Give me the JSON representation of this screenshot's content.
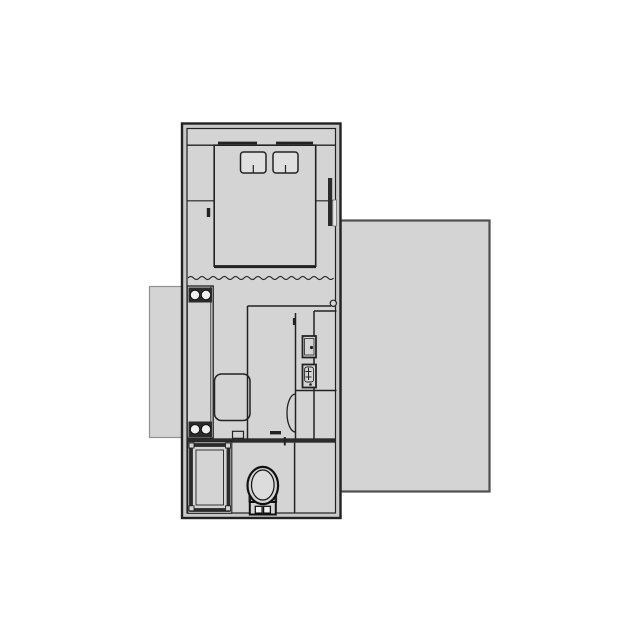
{
  "document": {
    "type": "floor-plan",
    "description": "Top-down architectural floor plan of a small rectangular dwelling unit with attached decks",
    "rooms": [
      {
        "name": "bedroom",
        "position": "top",
        "fixtures": [
          "bed",
          "pillow-left",
          "pillow-right",
          "head-wall-markers",
          "side-window",
          "curtain-divider"
        ]
      },
      {
        "name": "kitchen-living",
        "position": "middle",
        "fixtures": [
          "kitchen-counter",
          "cooktop-burners",
          "sink-bowls",
          "armchair",
          "tall-cabinet",
          "kitchen-sink-fixture",
          "cooktop-fixture",
          "door-swing",
          "door-hinge",
          "thresholds"
        ]
      },
      {
        "name": "bathroom",
        "position": "bottom",
        "fixtures": [
          "shower",
          "toilet",
          "bathroom-divider-wall"
        ]
      }
    ],
    "outdoor_areas": [
      {
        "name": "deck-right",
        "position": "right side, large"
      },
      {
        "name": "deck-left",
        "position": "left side, small"
      }
    ],
    "counts": {
      "pillows": 2,
      "burners_top": 2,
      "sink_bowls_bottom": 2,
      "decks": 2
    }
  },
  "palette": {
    "background": "#ffffff",
    "floor": "#d4d4d4",
    "wall_fill": "#c9c9c9",
    "line": "#222222",
    "line_dark": "#111111",
    "band": "#2b2b2b",
    "fixture_inner": "#dcdcdc",
    "pillow": "#e0e0e0",
    "white": "#f0f0f0",
    "deck_border_strong": "#4f4f4f",
    "deck_border_light": "#919191",
    "window_glass": "#e6e6e6"
  }
}
